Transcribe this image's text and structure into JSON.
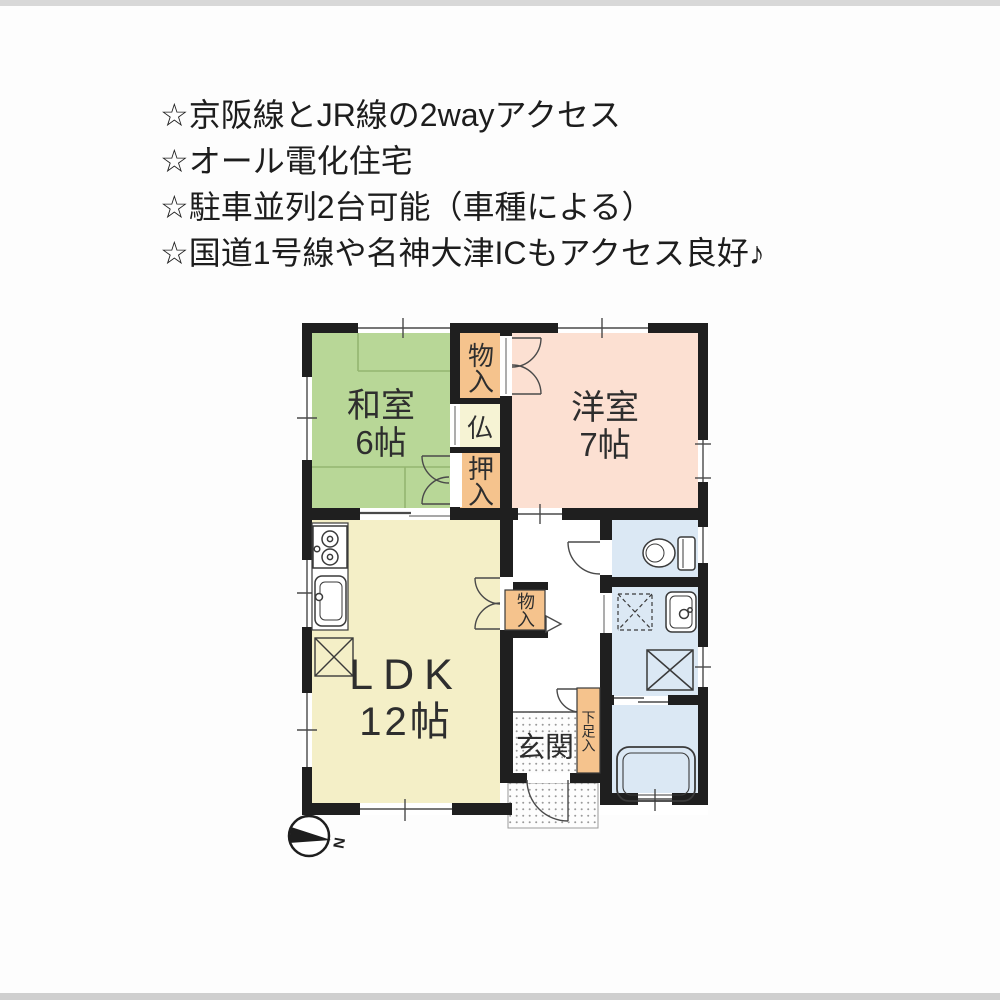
{
  "header": {
    "lines": [
      "☆京阪線とJR線の2wayアクセス",
      "☆オール電化住宅",
      "☆駐車並列2台可能（車種による）",
      "☆国道1号線や名神大津ICもアクセス良好♪"
    ]
  },
  "floorplan": {
    "labels": {
      "washitsu": "和室",
      "washitsu_size": "6帖",
      "youshitsu": "洋室",
      "youshitsu_size": "7帖",
      "ldk": "LDK",
      "ldk_size": "12帖",
      "genkan": "玄関",
      "closet_top": "物入",
      "butsudan": "仏",
      "oshiire": "押入",
      "closet_hall": "物入",
      "shoe_cabinet": "下足入",
      "compass_north": "N"
    },
    "colors": {
      "wall": "#1f1f1f",
      "tatami": "#b8d797",
      "western": "#fce0d2",
      "ldk": "#f4efc7",
      "closet": "#f5c38d",
      "altar": "#f6f3d4",
      "wet": "#dbe8f4"
    }
  }
}
